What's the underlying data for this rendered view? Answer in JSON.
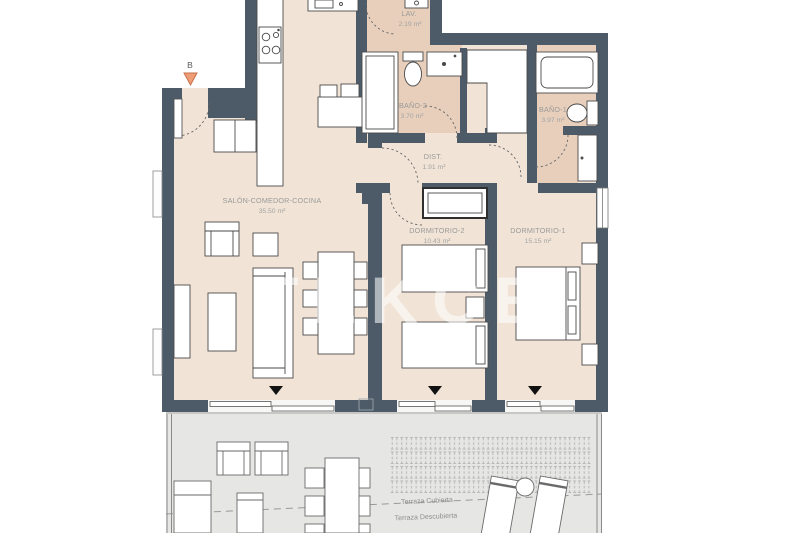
{
  "plan": {
    "watermark": "TEKCE",
    "entry_marker": {
      "label": "B"
    },
    "rooms": [
      {
        "id": "salon",
        "name": "SALÓN-COMEDOR-COCINA",
        "area": "35.50 m²"
      },
      {
        "id": "lav",
        "name": "LAV.",
        "area": "2.19 m²"
      },
      {
        "id": "bano2",
        "name": "BAÑO-2",
        "area": "3.70 m²"
      },
      {
        "id": "bano1",
        "name": "BAÑO-1",
        "area": "3.97 m²"
      },
      {
        "id": "dist",
        "name": "DIST.",
        "area": "1.91 m²"
      },
      {
        "id": "dorm2",
        "name": "DORMITORIO-2",
        "area": "10.43 m²"
      },
      {
        "id": "dorm1",
        "name": "DORMITORIO-1",
        "area": "15.15 m²"
      }
    ],
    "terrace_labels": [
      {
        "id": "terraza-cubierta",
        "name": "Terraza Cubierta"
      },
      {
        "id": "terraza-descubierta",
        "name": "Terraza Descubierta"
      }
    ],
    "colors": {
      "wall": "#4d5b69",
      "floor_main": "#f1e4d7",
      "floor_bath": "#e8cfbc",
      "floor_terrace": "#e6e6e4",
      "furniture_outline": "#4a4a4a",
      "entry_marker_orange": "#ef9d77",
      "entry_marker_border": "#c66f48",
      "slider_marker_black": "#111111",
      "label_gray": "#9a9a98",
      "watermark_white": "#ffffff"
    }
  }
}
